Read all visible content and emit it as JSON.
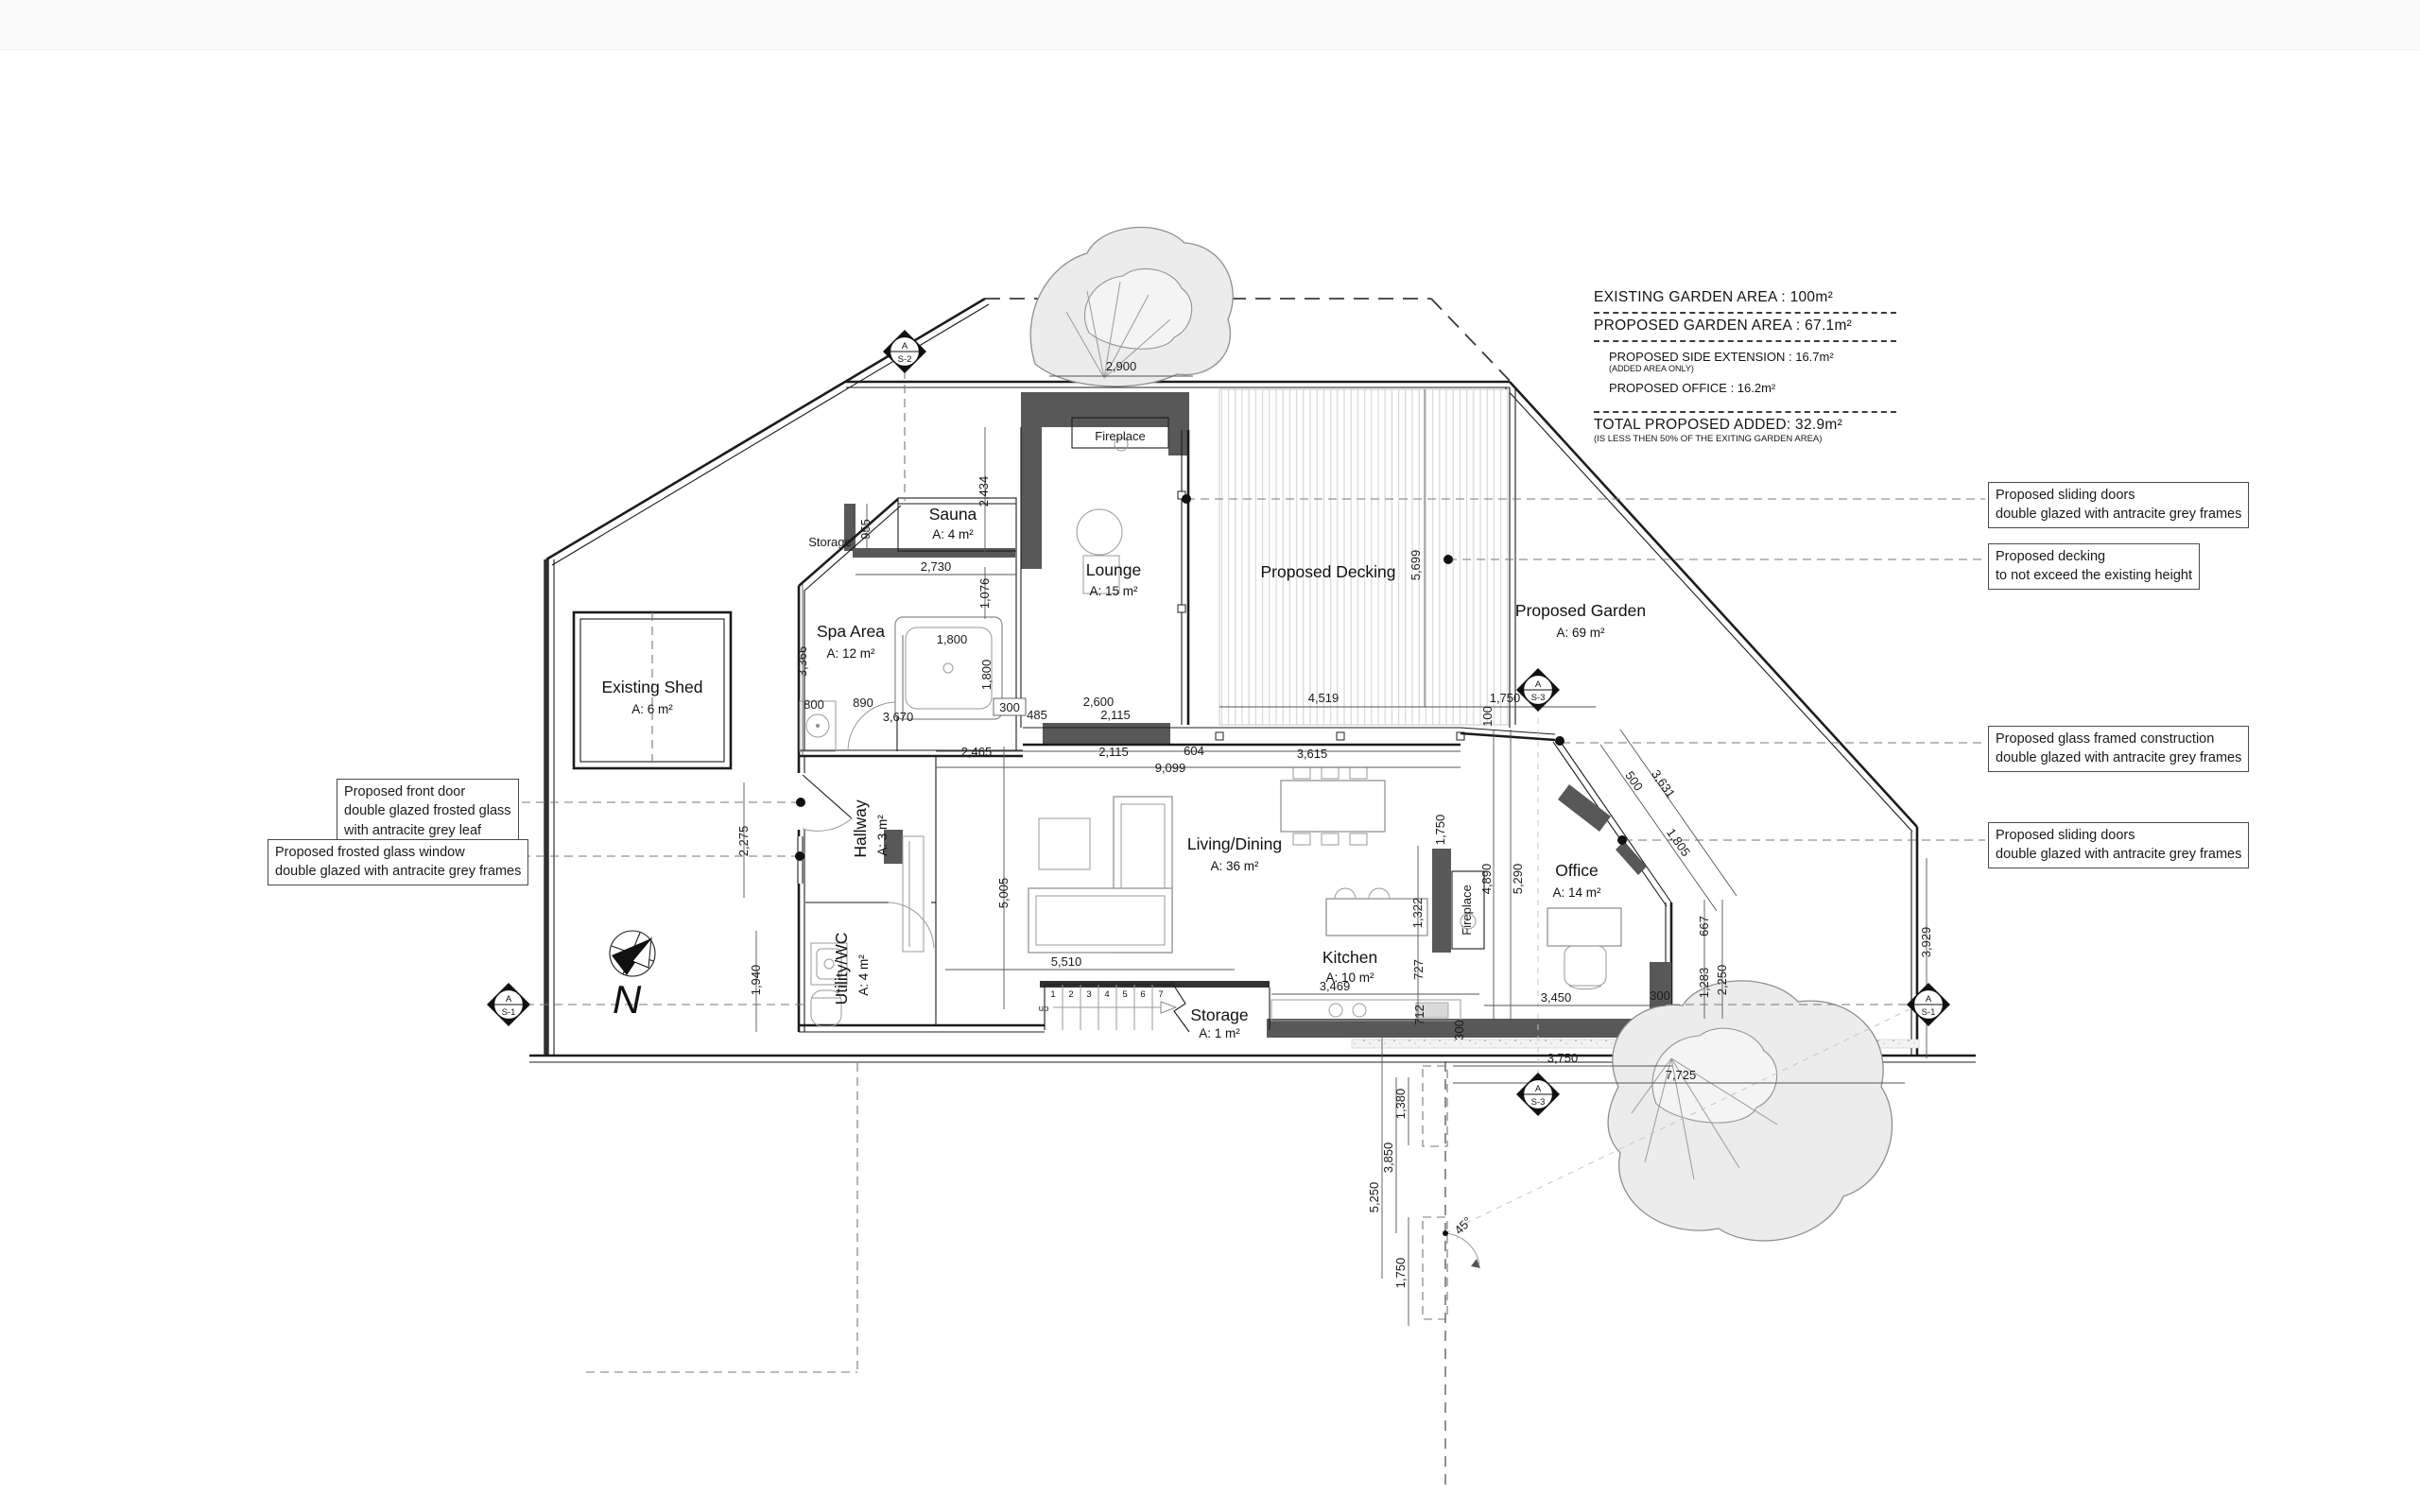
{
  "summary": {
    "line1": "EXISTING GARDEN AREA : 100m²",
    "line2": "PROPOSED GARDEN AREA : 67.1m²",
    "line3": "PROPOSED SIDE EXTENSION : 16.7m²",
    "line3_note": "(ADDED AREA ONLY)",
    "line4": "PROPOSED OFFICE : 16.2m²",
    "total": "TOTAL PROPOSED ADDED: 32.9m²",
    "total_note": "(IS LESS THEN 50% OF THE EXITING GARDEN AREA)"
  },
  "annotations": {
    "right": [
      {
        "lines": [
          "Proposed sliding doors",
          "double glazed with antracite grey frames"
        ]
      },
      {
        "lines": [
          "Proposed decking",
          "to not exceed the existing height"
        ]
      },
      {
        "lines": [
          "Proposed glass framed construction",
          "double glazed with antracite grey frames"
        ]
      },
      {
        "lines": [
          "Proposed sliding doors",
          "double glazed with antracite grey frames"
        ]
      }
    ],
    "left": [
      {
        "lines": [
          "Proposed front door",
          "double glazed frosted glass",
          "with antracite grey leaf"
        ]
      },
      {
        "lines": [
          "Proposed frosted glass window",
          "double glazed with antracite grey frames"
        ]
      }
    ]
  },
  "rooms": [
    {
      "name": "Existing Shed",
      "area": "A: 6 m²"
    },
    {
      "name": "Spa Area",
      "area": "A: 12 m²"
    },
    {
      "name": "Sauna",
      "area": "A: 4 m²"
    },
    {
      "name": "Lounge",
      "area": "A: 15 m²"
    },
    {
      "name": "Hallway",
      "area": "A: 3 m²"
    },
    {
      "name": "Utility/WC",
      "area": "A: 4 m²"
    },
    {
      "name": "Living/Dining",
      "area": "A: 36 m²"
    },
    {
      "name": "Kitchen",
      "area": "A: 10 m²"
    },
    {
      "name": "Office",
      "area": "A: 14 m²"
    },
    {
      "name": "Storage",
      "area": "A: 1 m²"
    },
    {
      "name": "Proposed Garden",
      "area": "A: 69 m²"
    }
  ],
  "labels": {
    "storage": "Storage",
    "decking": "Proposed Decking",
    "fireplace": "Fireplace",
    "up": "up",
    "north": "N"
  },
  "stairs": [
    "1",
    "2",
    "3",
    "4",
    "5",
    "6",
    "7"
  ],
  "markers": [
    {
      "letter": "A",
      "code": "S-2"
    },
    {
      "letter": "A",
      "code": "S-3"
    },
    {
      "letter": "A",
      "code": "S-1"
    },
    {
      "letter": "A",
      "code": "S-3"
    },
    {
      "letter": "A",
      "code": "S-1"
    }
  ],
  "dims": [
    "2,900",
    "2,434",
    "955",
    "2,730",
    "1,076",
    "3,366",
    "1,800",
    "1,800",
    "800",
    "890",
    "3,670",
    "300",
    "485",
    "2,600",
    "2,115",
    "2,465",
    "2,115",
    "604",
    "3,615",
    "9,099",
    "5,005",
    "5,510",
    "1,750",
    "1,322",
    "727",
    "712",
    "3,469",
    "4,890",
    "5,290",
    "3,450",
    "300",
    "300",
    "4,519",
    "5,699",
    "1,750",
    "100",
    "500",
    "3,631",
    "1,805",
    "667",
    "1,283",
    "2,250",
    "7,725",
    "3,750",
    "1,380",
    "3,850",
    "5,250",
    "1,750",
    "45°",
    "2,275",
    "1,940",
    "3,929"
  ],
  "colors": {
    "wall": "#585858",
    "line": "#1c1c1c",
    "tree_fill": "#ececec",
    "deck_hatch": "#d4d4d4"
  }
}
